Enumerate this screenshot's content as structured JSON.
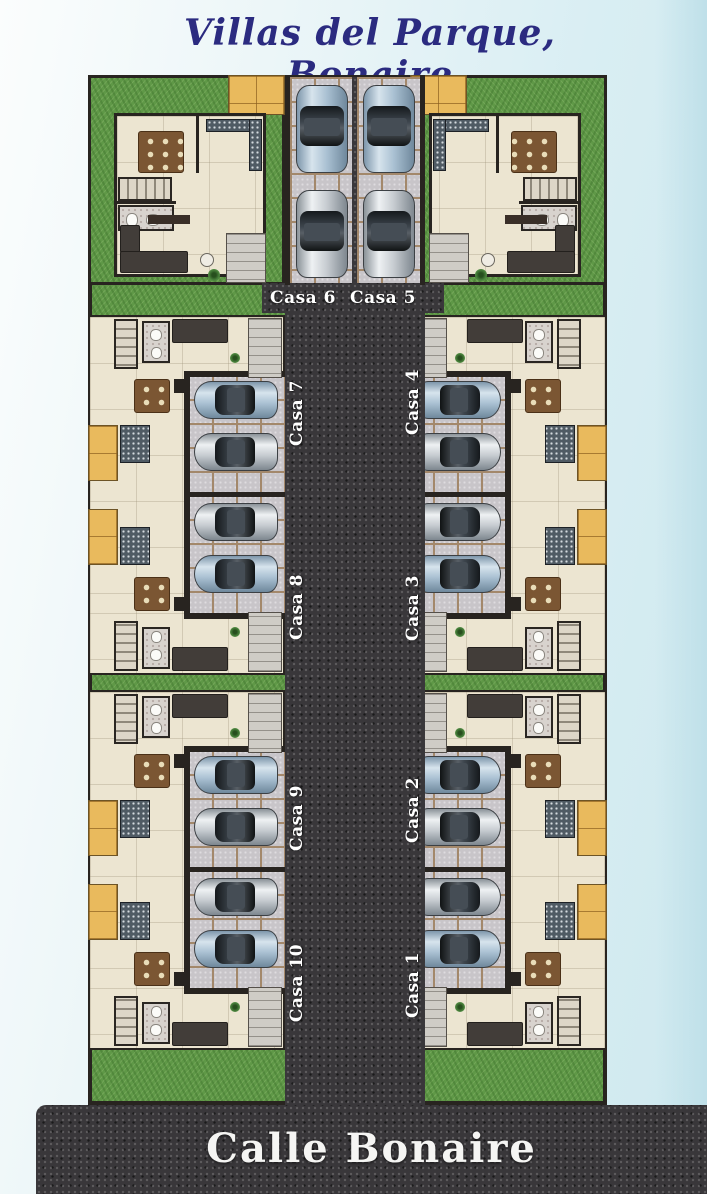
{
  "title": "Villas del Parque, Bonaire",
  "street_label": "Calle Bonaire",
  "units": {
    "casa1": "Casa 1",
    "casa2": "Casa 2",
    "casa3": "Casa 3",
    "casa4": "Casa 4",
    "casa5": "Casa 5",
    "casa6": "Casa 6",
    "casa7": "Casa 7",
    "casa8": "Casa 8",
    "casa9": "Casa 9",
    "casa10": "Casa 10"
  },
  "colors": {
    "background": "#d9eef3",
    "title_text": "#2b2b80",
    "label_text": "#ffffff",
    "asphalt": "#39373a",
    "grass": "#5f9847",
    "floor": "#ece5d1",
    "wall": "#282420",
    "paver": "#c8c5c9",
    "paver_joint": "#a3886b",
    "patio_tile": "#e9ba5d",
    "car_silver": "#c6cbd0",
    "car_blue": "#a9c0d2"
  }
}
